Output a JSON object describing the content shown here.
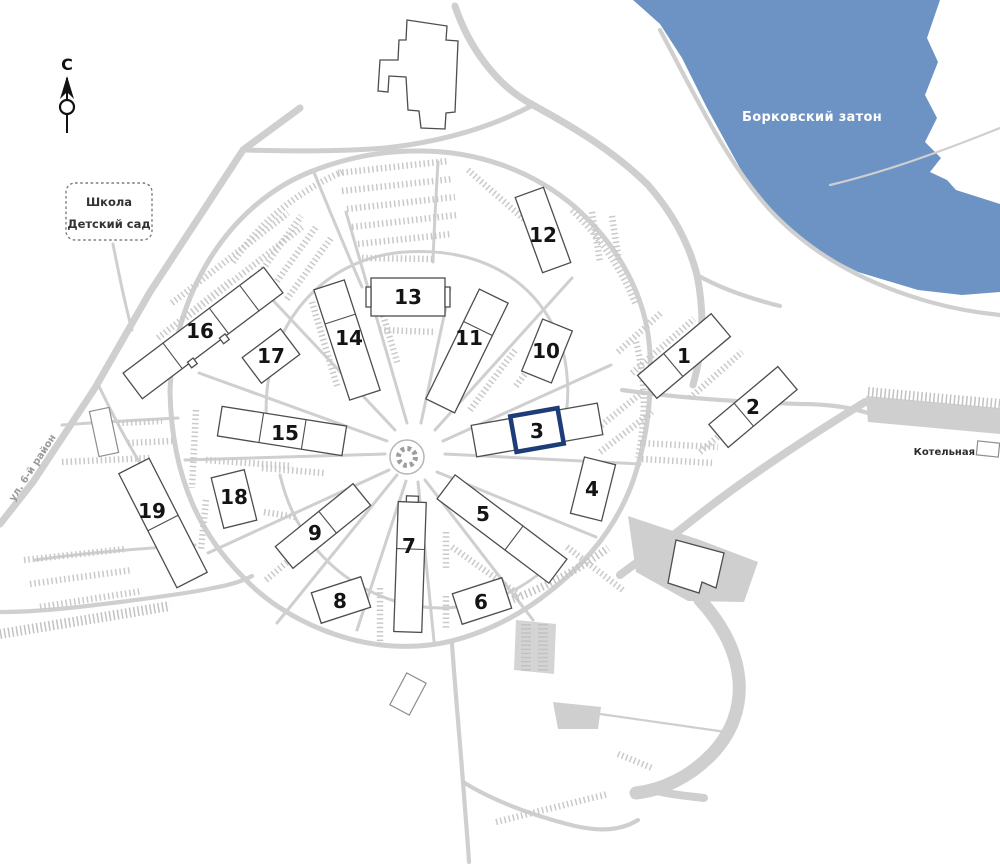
{
  "labels": {
    "water": "Борковский затон",
    "school_line1": "Школа",
    "school_line2": "Детский сад",
    "boiler": "Котельная",
    "street": "ул. 6-й район",
    "compass_north": "С"
  },
  "colors": {
    "water": "#6D93C4",
    "road": "#CFCFCF",
    "tree_row": "#C5C5C5",
    "building_fill": "#FFFFFF",
    "building_outline": "#4D4D4D",
    "number_text": "#141414",
    "highlight": "#1E3D78",
    "water_label_text": "#FFFFFF",
    "street_label_text": "#9A9A9A"
  },
  "highlighted_building": "3",
  "buildings": [
    {
      "number": "1"
    },
    {
      "number": "2"
    },
    {
      "number": "3"
    },
    {
      "number": "4"
    },
    {
      "number": "5"
    },
    {
      "number": "6"
    },
    {
      "number": "7"
    },
    {
      "number": "8"
    },
    {
      "number": "9"
    },
    {
      "number": "10"
    },
    {
      "number": "11"
    },
    {
      "number": "12"
    },
    {
      "number": "13"
    },
    {
      "number": "14"
    },
    {
      "number": "15"
    },
    {
      "number": "16"
    },
    {
      "number": "17"
    },
    {
      "number": "18"
    },
    {
      "number": "19"
    }
  ]
}
